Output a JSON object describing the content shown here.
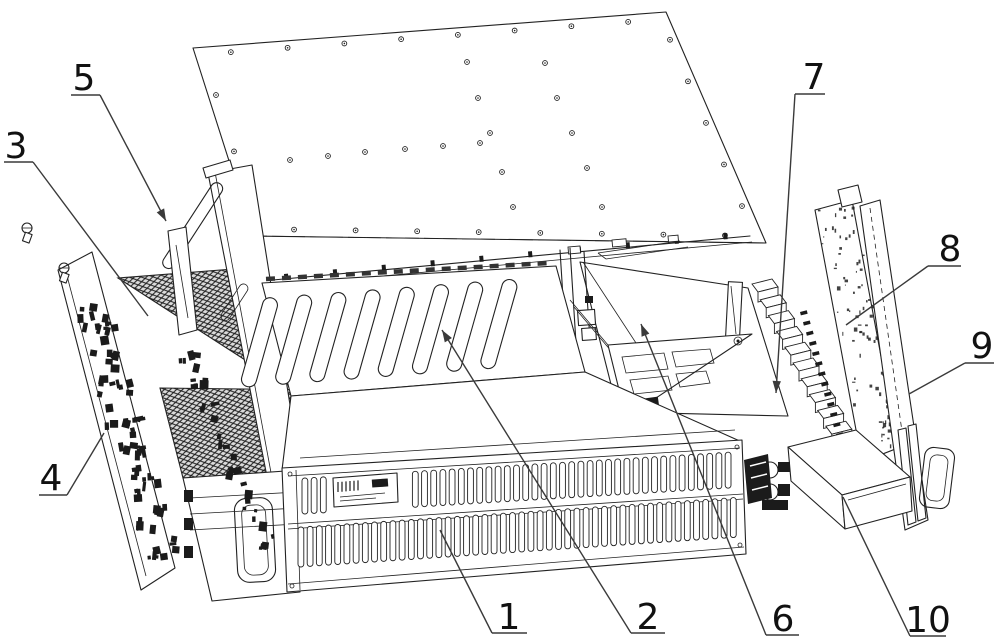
{
  "figure": {
    "type": "patent-exploded-diagram",
    "description": "Exploded isometric patent line drawing of a rack-mount electronics chassis assembly: top cover plate lifted above a chassis containing hatched heat sinks, a slotted mid deck, front vent grille, side connector panel, support gusset, rear card PCB, rear panel with handle and an accessory box. Parts are numbered 1-10 with leader lines.",
    "background": "#ffffff",
    "colors": {
      "line": "#222222",
      "dark": "#1b1b1b",
      "leader": "#3a3a3a",
      "text": "#111111"
    },
    "callouts": [
      {
        "label": "1",
        "text_x": 509,
        "text_y": 629,
        "bar": [
          492,
          633,
          527,
          633
        ],
        "leader": [
          492,
          633,
          440,
          530
        ],
        "arrow": false
      },
      {
        "label": "2",
        "text_x": 648,
        "text_y": 629,
        "bar": [
          631,
          633,
          665,
          633
        ],
        "leader": [
          631,
          633,
          442,
          330
        ],
        "arrow": true
      },
      {
        "label": "3",
        "text_x": 16,
        "text_y": 158,
        "bar": [
          4,
          162,
          33,
          162
        ],
        "leader": [
          33,
          162,
          148,
          316
        ],
        "arrow": false
      },
      {
        "label": "4",
        "text_x": 51,
        "text_y": 490,
        "bar": [
          39,
          495,
          67,
          495
        ],
        "leader": [
          67,
          495,
          104,
          433
        ],
        "arrow": false
      },
      {
        "label": "5",
        "text_x": 84,
        "text_y": 90,
        "bar": [
          71,
          95,
          100,
          95
        ],
        "leader": [
          100,
          95,
          166,
          221
        ],
        "arrow": true
      },
      {
        "label": "6",
        "text_x": 783,
        "text_y": 631,
        "bar": [
          766,
          635,
          799,
          635
        ],
        "leader": [
          766,
          635,
          641,
          324
        ],
        "arrow": true
      },
      {
        "label": "7",
        "text_x": 814,
        "text_y": 89,
        "bar": [
          795,
          94,
          825,
          94
        ],
        "leader": [
          795,
          94,
          776,
          393
        ],
        "arrow": true
      },
      {
        "label": "8",
        "text_x": 950,
        "text_y": 261,
        "bar": [
          928,
          266,
          961,
          266
        ],
        "leader": [
          928,
          266,
          846,
          325
        ],
        "arrow": false
      },
      {
        "label": "9",
        "text_x": 982,
        "text_y": 358,
        "bar": [
          965,
          363,
          994,
          363
        ],
        "leader": [
          965,
          363,
          909,
          394
        ],
        "arrow": false
      },
      {
        "label": "10",
        "text_x": 928,
        "text_y": 632,
        "bar": [
          910,
          636,
          946,
          636
        ],
        "leader": [
          910,
          636,
          843,
          497
        ],
        "arrow": false
      }
    ]
  }
}
